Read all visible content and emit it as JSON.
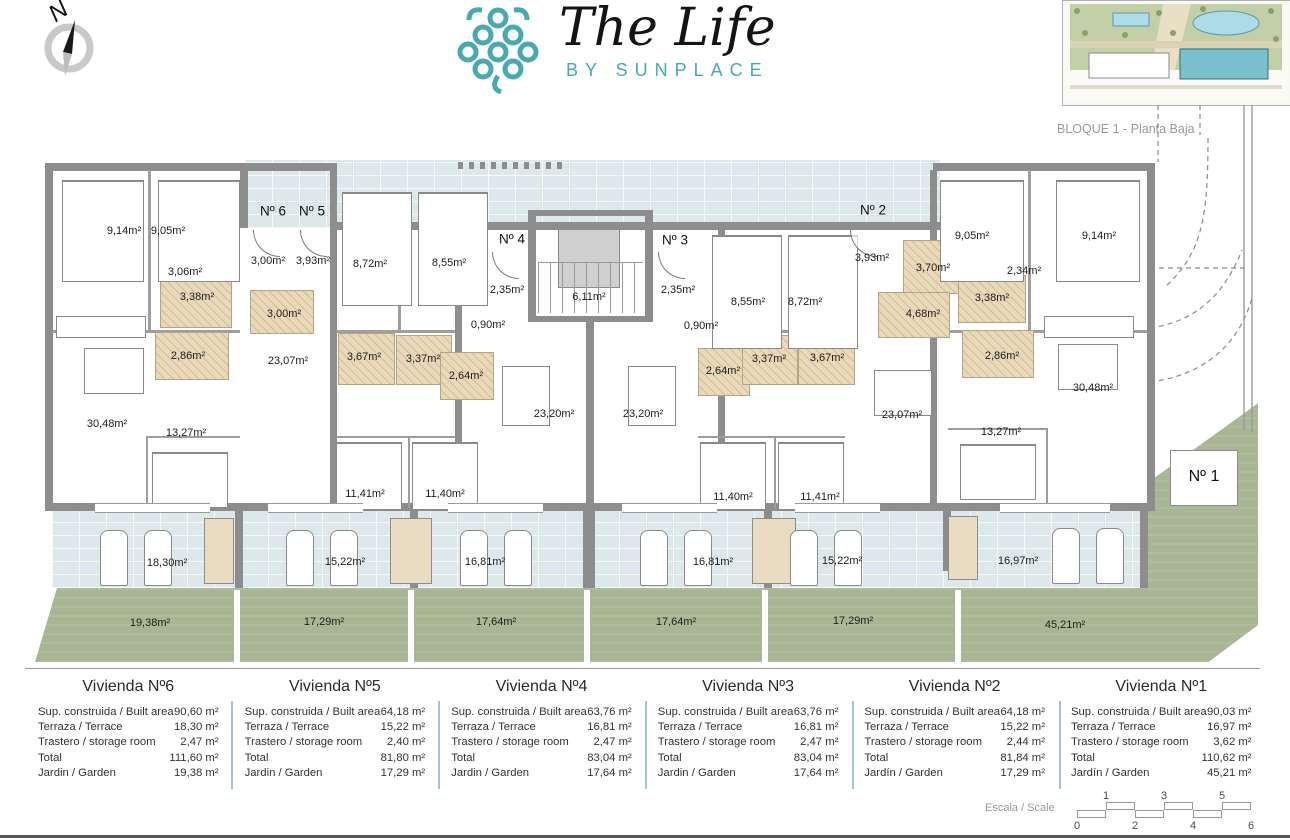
{
  "header": {
    "compass_label": "N",
    "logo_title": "The Life",
    "logo_subtitle": "BY SUNPLACE",
    "siteplan_caption": "BLOQUE 1 - Planta Baja"
  },
  "plan": {
    "room_labels": [
      {
        "text": "9,14m²",
        "x": 124,
        "y": 231
      },
      {
        "text": "9,05m²",
        "x": 168,
        "y": 231
      },
      {
        "text": "3,06m²",
        "x": 185,
        "y": 272
      },
      {
        "text": "3,00m²",
        "x": 268,
        "y": 261
      },
      {
        "text": "3,93m²",
        "x": 313,
        "y": 261
      },
      {
        "text": "3,38m²",
        "x": 197,
        "y": 297
      },
      {
        "text": "3,00m²",
        "x": 284,
        "y": 314
      },
      {
        "text": "2,86m²",
        "x": 188,
        "y": 356
      },
      {
        "text": "23,07m²",
        "x": 288,
        "y": 361
      },
      {
        "text": "30,48m²",
        "x": 107,
        "y": 424
      },
      {
        "text": "13,27m²",
        "x": 186,
        "y": 433
      },
      {
        "text": "8,72m²",
        "x": 370,
        "y": 264
      },
      {
        "text": "8,55m²",
        "x": 449,
        "y": 263
      },
      {
        "text": "2,35m²",
        "x": 507,
        "y": 290
      },
      {
        "text": "0,90m²",
        "x": 488,
        "y": 325
      },
      {
        "text": "6,11m²",
        "x": 589,
        "y": 297
      },
      {
        "text": "3,67m²",
        "x": 364,
        "y": 357
      },
      {
        "text": "3,37m²",
        "x": 423,
        "y": 359
      },
      {
        "text": "2,64m²",
        "x": 466,
        "y": 376
      },
      {
        "text": "23,20m²",
        "x": 554,
        "y": 414
      },
      {
        "text": "23,20m²",
        "x": 643,
        "y": 414
      },
      {
        "text": "2,35m²",
        "x": 678,
        "y": 290
      },
      {
        "text": "0,90m²",
        "x": 701,
        "y": 326
      },
      {
        "text": "8,55m²",
        "x": 748,
        "y": 302
      },
      {
        "text": "8,72m²",
        "x": 805,
        "y": 302
      },
      {
        "text": "2,64m²",
        "x": 723,
        "y": 371
      },
      {
        "text": "3,37m²",
        "x": 769,
        "y": 359
      },
      {
        "text": "3,67m²",
        "x": 827,
        "y": 358
      },
      {
        "text": "3,93m²",
        "x": 872,
        "y": 258
      },
      {
        "text": "3,70m²",
        "x": 933,
        "y": 268
      },
      {
        "text": "4,68m²",
        "x": 923,
        "y": 314
      },
      {
        "text": "23,07m²",
        "x": 902,
        "y": 415
      },
      {
        "text": "9,05m²",
        "x": 972,
        "y": 236
      },
      {
        "text": "9,14m²",
        "x": 1099,
        "y": 236
      },
      {
        "text": "2,34m²",
        "x": 1024,
        "y": 271
      },
      {
        "text": "3,38m²",
        "x": 992,
        "y": 298
      },
      {
        "text": "2,86m²",
        "x": 1002,
        "y": 356
      },
      {
        "text": "30,48m²",
        "x": 1093,
        "y": 388
      },
      {
        "text": "13,27m²",
        "x": 1001,
        "y": 432
      },
      {
        "text": "11,41m²",
        "x": 365,
        "y": 494
      },
      {
        "text": "11,40m²",
        "x": 445,
        "y": 494
      },
      {
        "text": "11,40m²",
        "x": 733,
        "y": 497
      },
      {
        "text": "11,41m²",
        "x": 820,
        "y": 497
      },
      {
        "text": "18,30m²",
        "x": 167,
        "y": 563
      },
      {
        "text": "15,22m²",
        "x": 345,
        "y": 562
      },
      {
        "text": "16,81m²",
        "x": 485,
        "y": 562
      },
      {
        "text": "16,81m²",
        "x": 713,
        "y": 562
      },
      {
        "text": "15,22m²",
        "x": 842,
        "y": 561
      },
      {
        "text": "16,97m²",
        "x": 1018,
        "y": 561
      },
      {
        "text": "19,38m²",
        "x": 150,
        "y": 623
      },
      {
        "text": "17,29m²",
        "x": 324,
        "y": 622
      },
      {
        "text": "17,64m²",
        "x": 496,
        "y": 622
      },
      {
        "text": "17,64m²",
        "x": 676,
        "y": 622
      },
      {
        "text": "17,29m²",
        "x": 853,
        "y": 621
      },
      {
        "text": "45,21m²",
        "x": 1065,
        "y": 625
      }
    ],
    "entrance_labels": [
      {
        "text": "Nº 6",
        "x": 273,
        "y": 211
      },
      {
        "text": "Nº 5",
        "x": 312,
        "y": 211
      },
      {
        "text": "Nº 4",
        "x": 512,
        "y": 239
      },
      {
        "text": "Nº 3",
        "x": 675,
        "y": 240
      },
      {
        "text": "Nº 2",
        "x": 873,
        "y": 210
      },
      {
        "text": "Nº 1",
        "x": 1204,
        "y": 477,
        "large": true
      }
    ]
  },
  "units": [
    {
      "title": "Vivienda Nº6",
      "rows": [
        [
          "Sup. construida / Built area",
          "90,60 m²"
        ],
        [
          "Terraza / Terrace",
          "18,30 m²"
        ],
        [
          "Trastero / storage room",
          "2,47 m²"
        ],
        [
          "Total",
          "111,60 m²"
        ],
        [
          "Jardin / Garden",
          "19,38 m²"
        ]
      ]
    },
    {
      "title": "Vivienda Nº5",
      "rows": [
        [
          "Sup. construida / Built area",
          "64,18 m²"
        ],
        [
          "Terraza / Terrace",
          "15,22 m²"
        ],
        [
          "Trastero / storage room",
          "2,40 m²"
        ],
        [
          "Total",
          "81,80 m²"
        ],
        [
          "Jardin / Garden",
          "17,29 m²"
        ]
      ]
    },
    {
      "title": "Vivienda Nº4",
      "rows": [
        [
          "Sup. construida / Built area",
          "63,76 m²"
        ],
        [
          "Terraza / Terrace",
          "16,81 m²"
        ],
        [
          "Trastero / storage room",
          "2,47 m²"
        ],
        [
          "Total",
          "83,04 m²"
        ],
        [
          "Jardin / Garden",
          "17,64 m²"
        ]
      ]
    },
    {
      "title": "Vivienda Nº3",
      "rows": [
        [
          "Sup. construida / Built area",
          "63,76 m²"
        ],
        [
          "Terraza / Terrace",
          "16,81 m²"
        ],
        [
          "Trastero / storage room",
          "2,47 m²"
        ],
        [
          "Total",
          "83,04 m²"
        ],
        [
          "Jardin / Garden",
          "17,64 m²"
        ]
      ]
    },
    {
      "title": "Vivienda Nº2",
      "rows": [
        [
          "Sup. construida / Built area",
          "64,18 m²"
        ],
        [
          "Terraza / Terrace",
          "15,22 m²"
        ],
        [
          "Trastero / storage room",
          "2,44 m²"
        ],
        [
          "Total",
          "81,84 m²"
        ],
        [
          "Jardín / Garden",
          "17,29 m²"
        ]
      ]
    },
    {
      "title": "Vivienda Nº1",
      "rows": [
        [
          "Sup. construida / Built area",
          "90,03 m²"
        ],
        [
          "Terraza / Terrace",
          "16,97 m²"
        ],
        [
          "Trastero / storage room",
          "3,62 m²"
        ],
        [
          "Total",
          "110,62 m²"
        ],
        [
          "Jardín / Garden",
          "45,21 m²"
        ]
      ]
    }
  ],
  "scale_bar": {
    "label": "Escala / Scale",
    "upper_ticks": [
      "1",
      "3",
      "5"
    ],
    "lower_ticks": [
      "0",
      "2",
      "4",
      "6"
    ]
  },
  "colors": {
    "brand_teal": "#49a8b2",
    "garden_green": "#a8b694",
    "terrace_blue": "#dde8ea",
    "wall_gray": "#8d8d8d"
  }
}
